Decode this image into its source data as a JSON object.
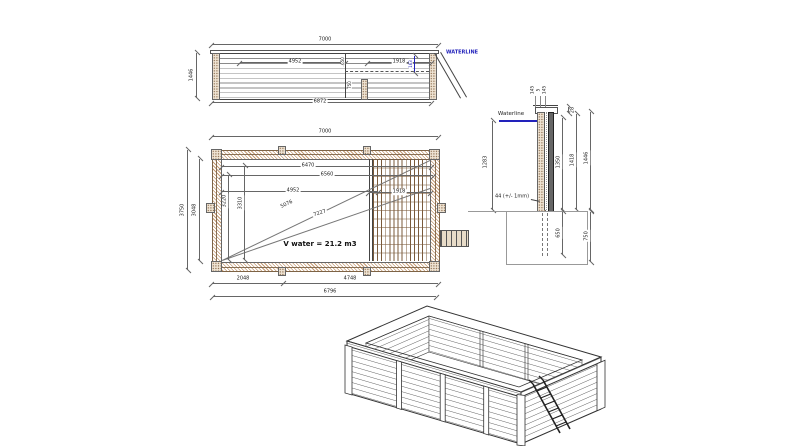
{
  "colors": {
    "waterline_blue": "#2222bb",
    "wood_tan": "#c49a72",
    "deck_brown": "#7a5a3a"
  },
  "elevation": {
    "dim_top": "7000",
    "dim_left": "1446",
    "dim_bottom": "6872",
    "dim_mid": "4952",
    "dim_right": "1918",
    "waterline": "WATERLINE",
    "dim_waterline": "163",
    "dim_upper_small": "650",
    "dim_lower_small": "750"
  },
  "plan": {
    "dim_top": "7000",
    "dim_outer_h": "3750",
    "dim_inner_h": "3048",
    "dim_a": "6470",
    "dim_b": "6560",
    "dim_c": "4952",
    "dim_deck": "1918",
    "diag_a": "5076",
    "diag_b": "7227",
    "dim_va": "3310",
    "dim_vb": "3220",
    "dim_ba": "2048",
    "dim_bb": "4748",
    "dim_bc": "6796",
    "volume": "V water = 21.2 m3"
  },
  "section": {
    "waterline": "Waterline",
    "cap": [
      "145",
      "5",
      "145"
    ],
    "dim_top_offset": "28",
    "dim_inner": "1350",
    "dim_mid": "1418",
    "dim_total": "1446",
    "dim_depth": "1283",
    "thickness": "44 (+/- 1mm)",
    "dim_below_inner": "650",
    "dim_below_outer": "750"
  }
}
